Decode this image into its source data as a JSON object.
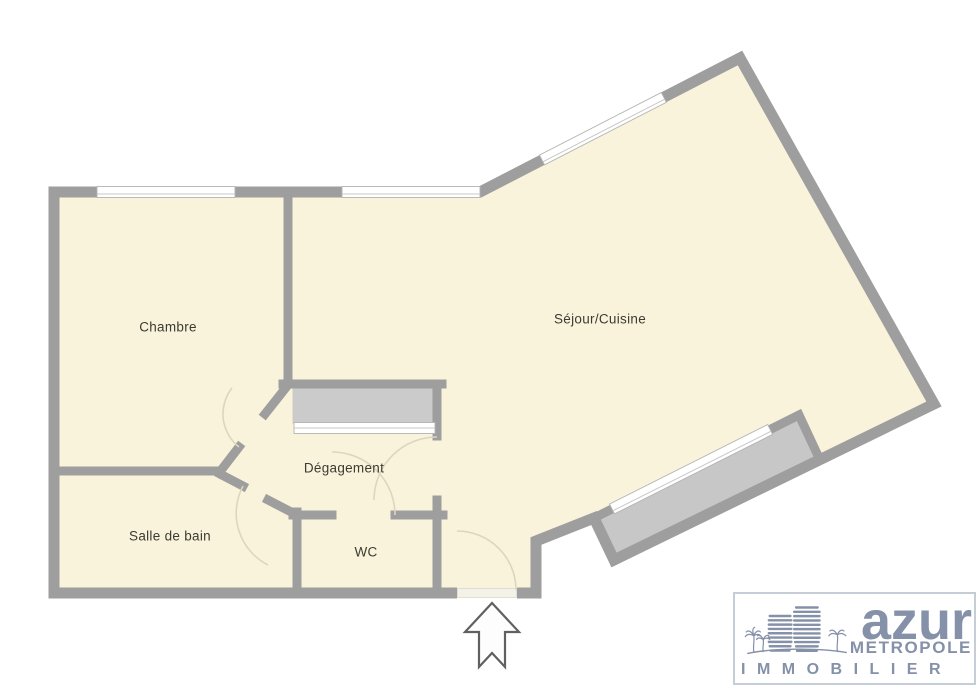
{
  "rooms": [
    {
      "name": "Chambre"
    },
    {
      "name": "Séjour/Cuisine"
    },
    {
      "name": "Dégagement"
    },
    {
      "name": "Salle de bain"
    },
    {
      "name": "WC"
    }
  ],
  "logo": {
    "brand": "azur",
    "subtitle": "METROPOLE",
    "banner": "IMMOBILIER"
  },
  "icons": {
    "entrance": "up-arrow-outline-icon",
    "logo_mark": "building-with-palm-trees-icon"
  },
  "colors": {
    "floor": "#FAF3DB",
    "wall": "#9E9E9E",
    "balcony": "#C7C7C7",
    "closet": "#CBCBCB",
    "window": "#FFFFFF",
    "window_edge": "#B3B3B3",
    "door_arc": "#DCD5C0",
    "arrow": "#606060",
    "label": "#3B3B33",
    "logo_blue": "#8591A8",
    "logo_border": "#C5CED6"
  }
}
